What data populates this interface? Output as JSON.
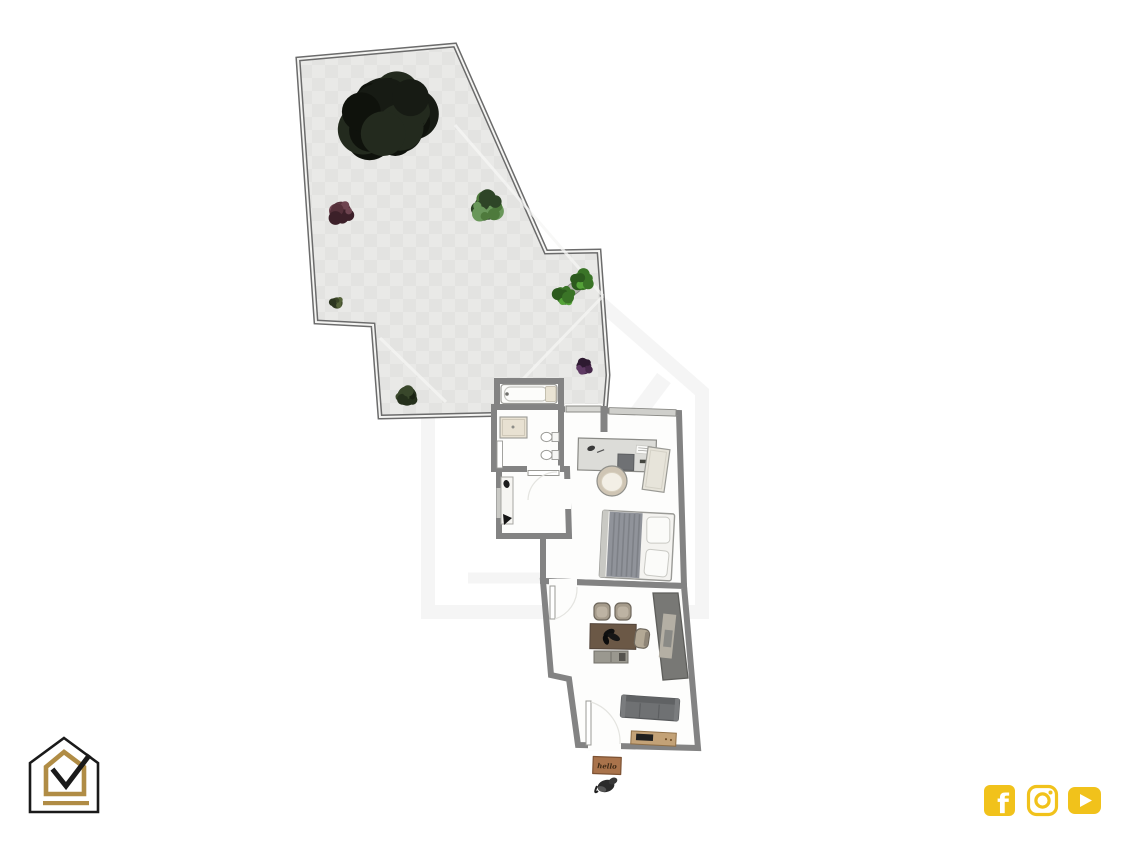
{
  "page": {
    "title": "apartment-and-garden-floor-plan",
    "background": "#ffffff"
  },
  "floorplan": {
    "doormat_text": "hello",
    "garden": {
      "name": "garden-terrace",
      "surface_colors": [
        "#e9e9e7",
        "#e2e2e0"
      ],
      "wall_color": "#6b6b6b",
      "plants": [
        {
          "name": "large-tree",
          "cx": 387,
          "cy": 114,
          "r": 46,
          "colors": [
            "#171b14",
            "#232a1e",
            "#0f120c"
          ]
        },
        {
          "name": "red-leaf-bush",
          "cx": 341,
          "cy": 212,
          "r": 13,
          "colors": [
            "#55303a",
            "#6e4450",
            "#3c2029"
          ]
        },
        {
          "name": "green-shrub",
          "cx": 487,
          "cy": 207,
          "r": 16,
          "colors": [
            "#2e4527",
            "#4e7a3c",
            "#69975a"
          ]
        },
        {
          "name": "small-bush",
          "cx": 337,
          "cy": 303,
          "r": 7,
          "colors": [
            "#3a4527",
            "#55633a",
            "#2c3520"
          ]
        },
        {
          "name": "potted-plant",
          "cx": 573,
          "cy": 289,
          "r": 14,
          "pot": true,
          "colors": [
            "#3a7427",
            "#54a238",
            "#2c5a1e"
          ]
        },
        {
          "name": "purple-plant",
          "cx": 584,
          "cy": 367,
          "r": 9,
          "colors": [
            "#46284a",
            "#5f3a64",
            "#2e1a31"
          ]
        },
        {
          "name": "dark-bush",
          "cx": 407,
          "cy": 396,
          "r": 12,
          "colors": [
            "#25301c",
            "#39472b",
            "#1a2213"
          ]
        }
      ]
    },
    "apartment": {
      "wall_color": "#838383",
      "floor_color": "#fdfdfc",
      "rooms": [
        {
          "name": "bath-room",
          "furniture": [
            "bathtub"
          ]
        },
        {
          "name": "shower-room",
          "furniture": [
            "shower",
            "toilet",
            "bidet"
          ]
        },
        {
          "name": "entrance-hall",
          "furniture": [
            "console-bench"
          ]
        },
        {
          "name": "bedroom",
          "furniture": [
            "desk",
            "desk-chair",
            "wardrobe",
            "double-bed"
          ]
        },
        {
          "name": "living-kitchen",
          "furniture": [
            "dining-table",
            "dining-chairs",
            "kitchen-counter",
            "storage-bench",
            "sofa",
            "tv-sideboard"
          ]
        }
      ],
      "outside_items": [
        "hello-doormat",
        "dark-figurine"
      ]
    }
  },
  "branding": {
    "logo_name": "house-checkmark-logo",
    "logo_colors": {
      "outline": "#1a1a1a",
      "accent": "#b08c45"
    }
  },
  "social": {
    "accent": "#f1c21b",
    "icons": [
      {
        "name": "facebook"
      },
      {
        "name": "instagram"
      },
      {
        "name": "youtube"
      }
    ]
  }
}
